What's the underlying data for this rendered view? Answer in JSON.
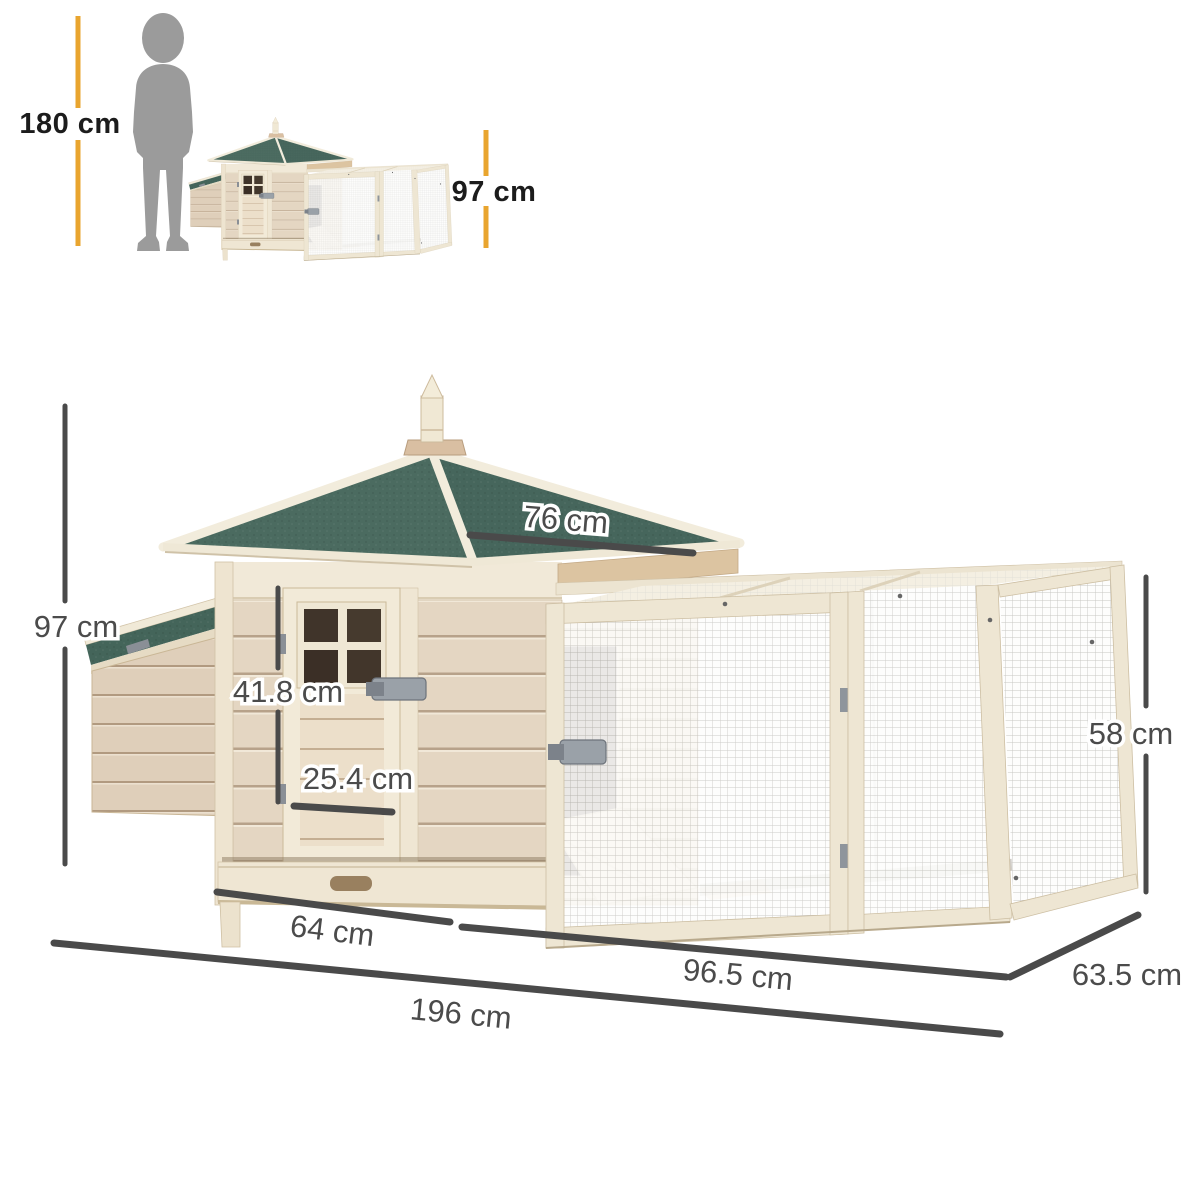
{
  "scale": {
    "person_height": "180 cm",
    "coop_height": "97 cm"
  },
  "dims": {
    "overall_height": "97 cm",
    "roof_width": "76 cm",
    "door_height": "41.8 cm",
    "door_width": "25.4 cm",
    "coop_width": "64 cm",
    "run_length": "96.5 cm",
    "run_depth": "63.5 cm",
    "overall_length": "196 cm",
    "run_height": "58 cm"
  },
  "colors": {
    "accent_yellow": "#E9A52F",
    "dimension_gray": "#4A4A4A",
    "roof_green": "#4B6B60",
    "wood_light": "#E4D6C2",
    "trim_cream": "#EFE7D5",
    "silhouette_gray": "#9B9B9B"
  },
  "icons": {
    "person": "human-silhouette-icon"
  }
}
